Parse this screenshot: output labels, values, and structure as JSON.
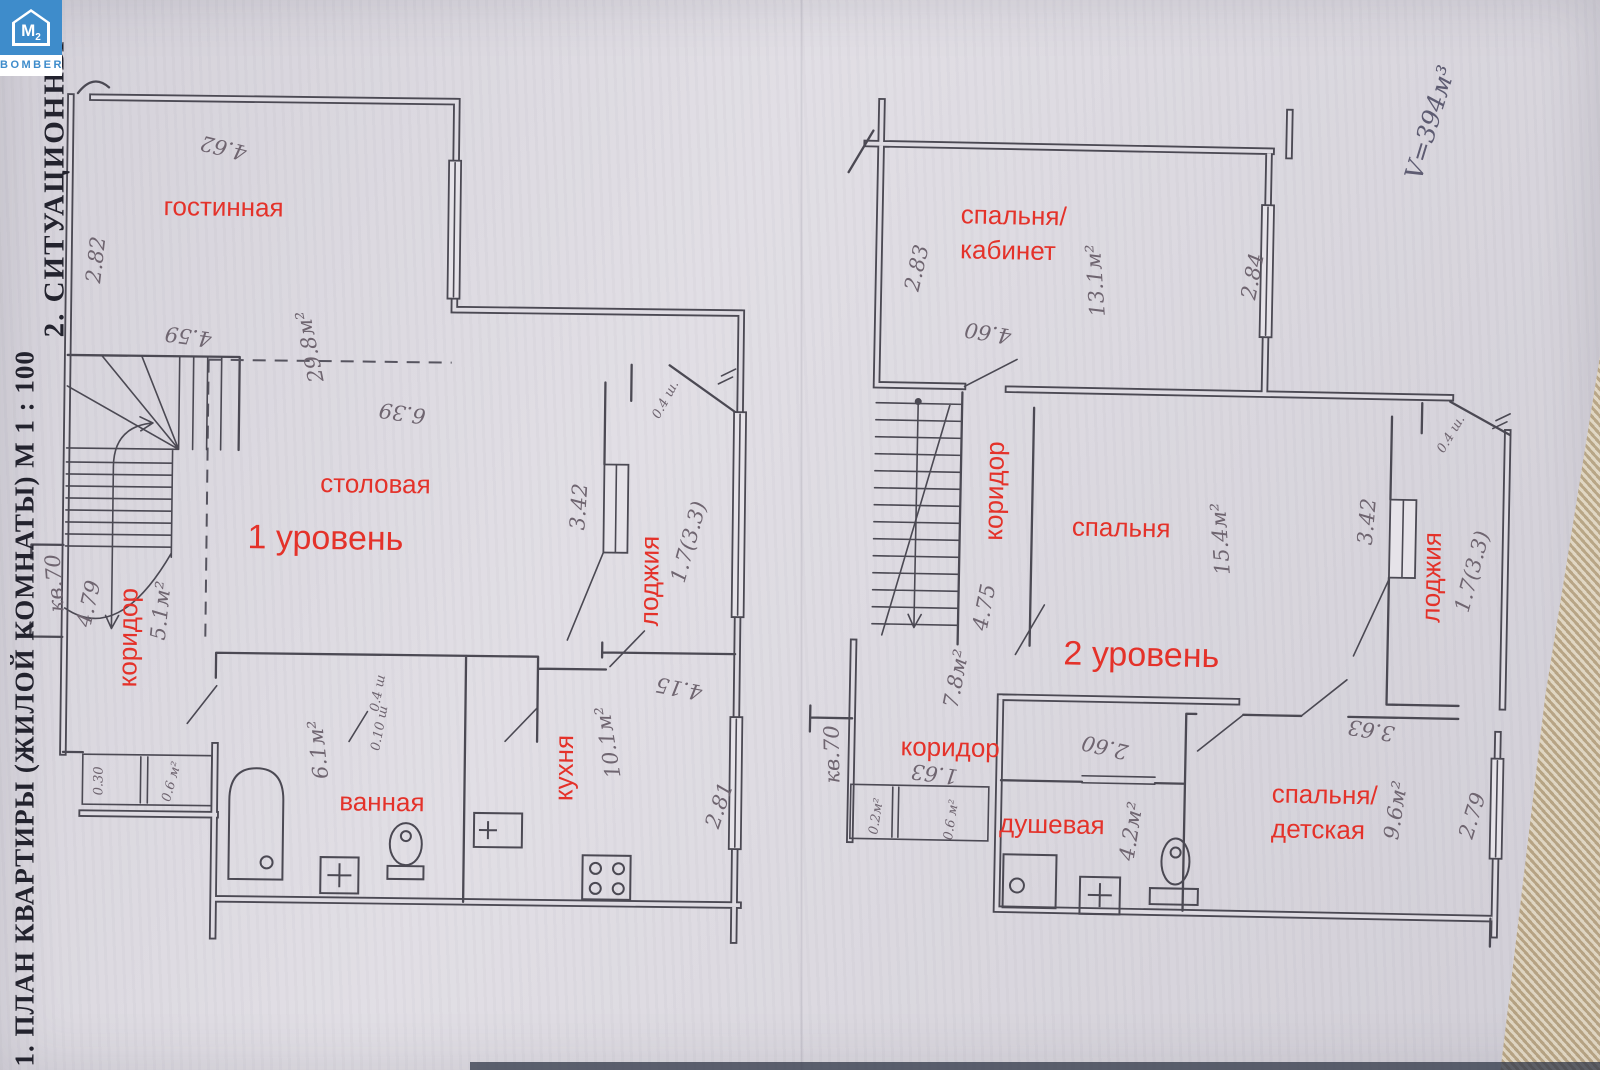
{
  "logo": {
    "m": "М",
    "sup": "2",
    "brand": "BOMBER"
  },
  "margins": {
    "caption_plan": "1. ПЛАН КВАРТИРЫ (ЖИЛОЙ КОМНАТЫ) М 1 : 100",
    "caption_situation": "2. СИТУАЦИОННЫ",
    "volume": "V=394м³"
  },
  "colors": {
    "label_red": "#e4322a",
    "logo_blue": "#3e8ccb",
    "paper": "#dedbe2",
    "ink": "#4b4953",
    "pencil": "#6f6570"
  },
  "level1": {
    "title": "1 уровень",
    "rooms": {
      "living": "гостинная",
      "dining": "столовая",
      "corridor": "коридор",
      "bath": "ванная",
      "kitchen": "кухня",
      "loggia": "лоджия"
    },
    "dims": {
      "living_top": "4.62",
      "living_left": "2.82",
      "living_bottom": "4.59",
      "living_area": "29.8м²",
      "dining_width": "6.39",
      "apt_no": "кв.70",
      "corridor_len": "4.79",
      "corridor_area": "5.1м²",
      "wc_width": "0.30",
      "wc_area": "0.6 м²",
      "bath_area": "6.1м²",
      "closet_a": "0.4 ш",
      "closet_b": "0.10 ш",
      "loggia_len": "3.42",
      "loggia_area": "1.7(3.3)",
      "loggia_closet": "0.4 ш.",
      "kitchen_width": "4.15",
      "kitchen_area": "10.1м²",
      "kitchen_depth": "2.81"
    }
  },
  "level2": {
    "title": "2 уровень",
    "rooms": {
      "bedroom_office_1": "спальня/",
      "bedroom_office_2": "кабинет",
      "corridor": "коридор",
      "bedroom": "спальня",
      "loggia": "лоджия",
      "hall": "коридор",
      "shower": "душевая",
      "bedroom_kids_1": "спальня/",
      "bedroom_kids_2": "детская"
    },
    "dims": {
      "office_left": "2.83",
      "office_area": "13.1м²",
      "office_right": "2.84",
      "office_width": "4.60",
      "stairs_len": "4.75",
      "corridor_area": "7.8м²",
      "bedroom_area": "15.4м²",
      "loggia_len": "3.42",
      "loggia_area": "1.7(3.3)",
      "loggia_closet": "0.4 ш.",
      "apt_no": "кв.70",
      "hall_width": "1.63",
      "wc_a": "0.2м²",
      "wc_b": "0.6 м²",
      "shower_top": "2.60",
      "shower_area": "4.2м²",
      "kids_area": "9.6м²",
      "kids_right": "2.79",
      "kids_top": "3.63"
    }
  }
}
